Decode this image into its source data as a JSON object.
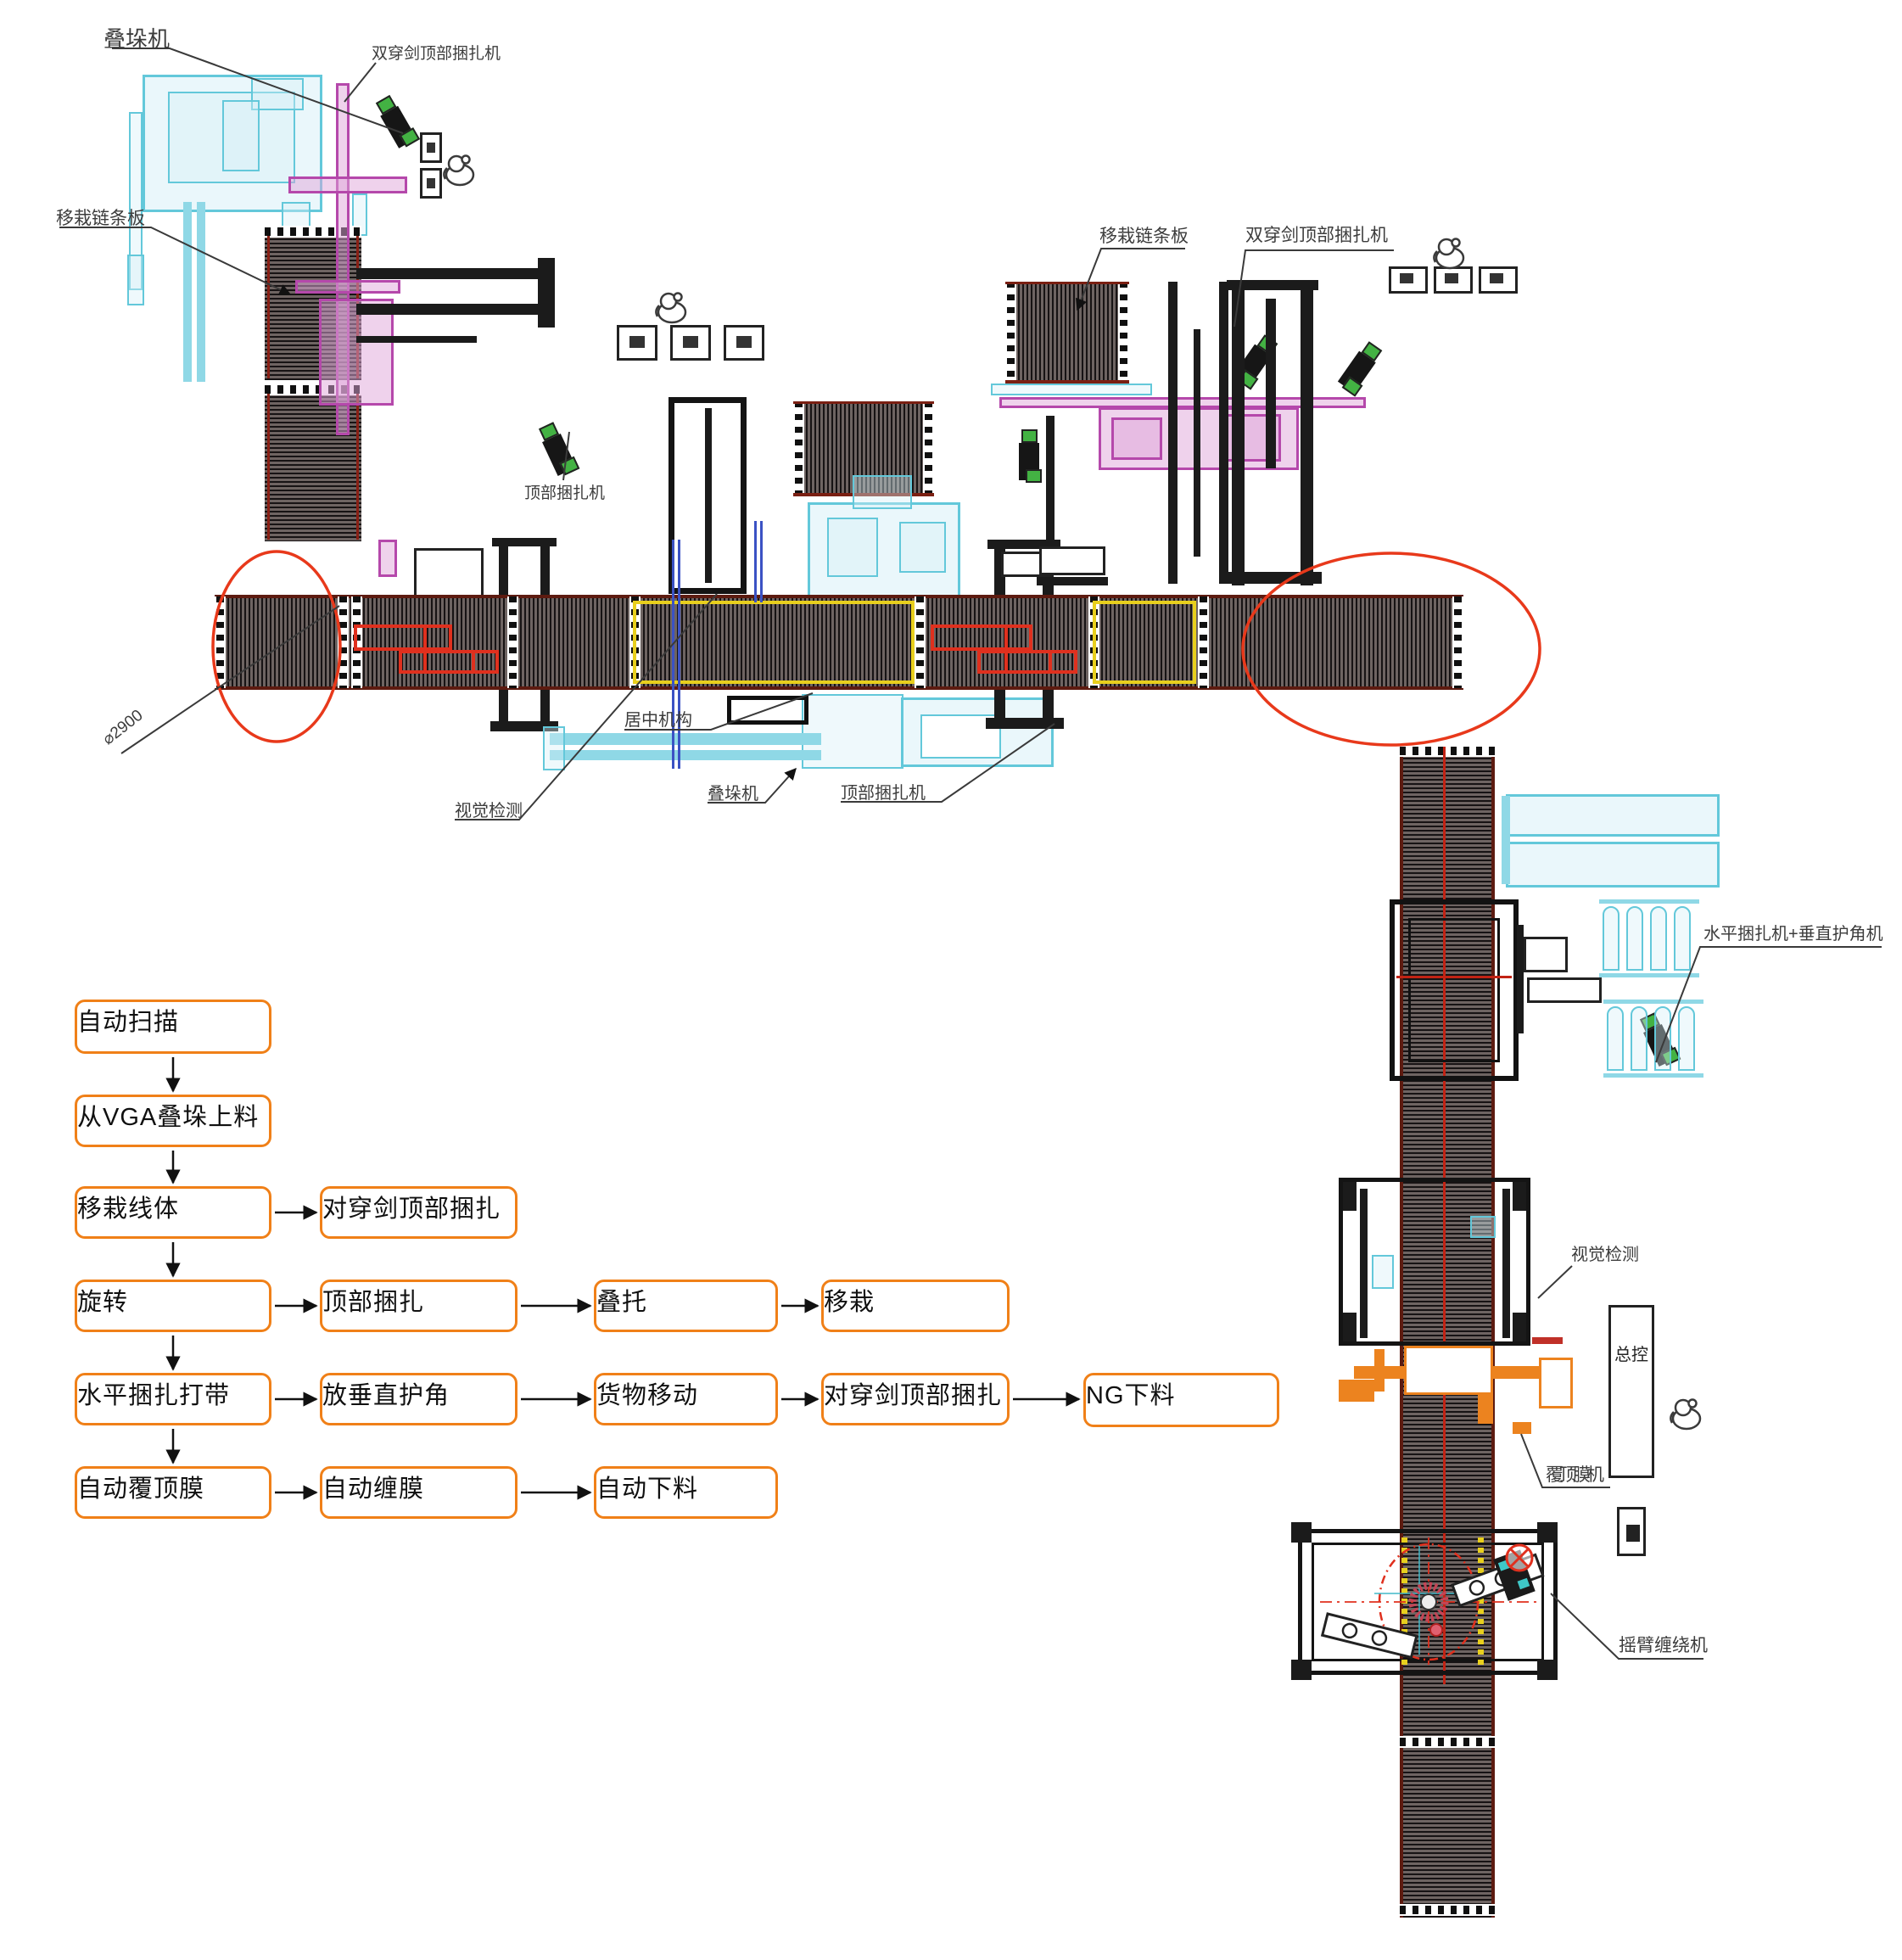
{
  "callouts": [
    {
      "id": "stacker-top-left",
      "text": "叠垛机"
    },
    {
      "id": "double-sword-top-strapper-left",
      "text": "双穿剑顶部捆扎机"
    },
    {
      "id": "transfer-chain-plate-left",
      "text": "移栽链条板"
    },
    {
      "id": "top-strapper-upper",
      "text": "顶部捆扎机"
    },
    {
      "id": "diameter-dimension",
      "text": "⌀2900"
    },
    {
      "id": "centering-mechanism",
      "text": "居中机构"
    },
    {
      "id": "vision-inspection-mid",
      "text": "视觉检测"
    },
    {
      "id": "stacker-bottom",
      "text": "叠垛机"
    },
    {
      "id": "top-strapper-bottom",
      "text": "顶部捆扎机"
    },
    {
      "id": "transfer-chain-plate-right",
      "text": "移栽链条板"
    },
    {
      "id": "double-sword-top-strapper-right",
      "text": "双穿剑顶部捆扎机"
    },
    {
      "id": "horizontal-strapper-corner-machine",
      "text": "水平捆扎机+垂直护角机"
    },
    {
      "id": "vision-inspection-right",
      "text": "视觉检测"
    },
    {
      "id": "master-control",
      "text": "总控"
    },
    {
      "id": "top-film-machine",
      "text": "覆顶膜机"
    },
    {
      "id": "rotary-arm-wrapper",
      "text": "摇臂缠绕机"
    }
  ],
  "flowchart": {
    "boxes": [
      {
        "label": "自动扫描"
      },
      {
        "label": "从VGA叠垛上料"
      },
      {
        "label": "移栽线体"
      },
      {
        "label": "对穿剑顶部捆扎"
      },
      {
        "label": "旋转"
      },
      {
        "label": "顶部捆扎"
      },
      {
        "label": "叠托"
      },
      {
        "label": "移栽"
      },
      {
        "label": "水平捆扎打带"
      },
      {
        "label": "放垂直护角"
      },
      {
        "label": "货物移动"
      },
      {
        "label": "对穿剑顶部捆扎"
      },
      {
        "label": "NG下料"
      },
      {
        "label": "自动覆顶膜"
      },
      {
        "label": "自动缠膜"
      },
      {
        "label": "自动下料"
      }
    ]
  },
  "colors": {
    "flow_accent": "#f08018",
    "highlight_red": "#e8391b",
    "cyan_machine": "#63c8da",
    "magenta_machine": "#b548ab",
    "yellow_zone": "#e8cf1d",
    "orange_machine": "#ec831f",
    "blue_marker": "#3b52c4"
  }
}
